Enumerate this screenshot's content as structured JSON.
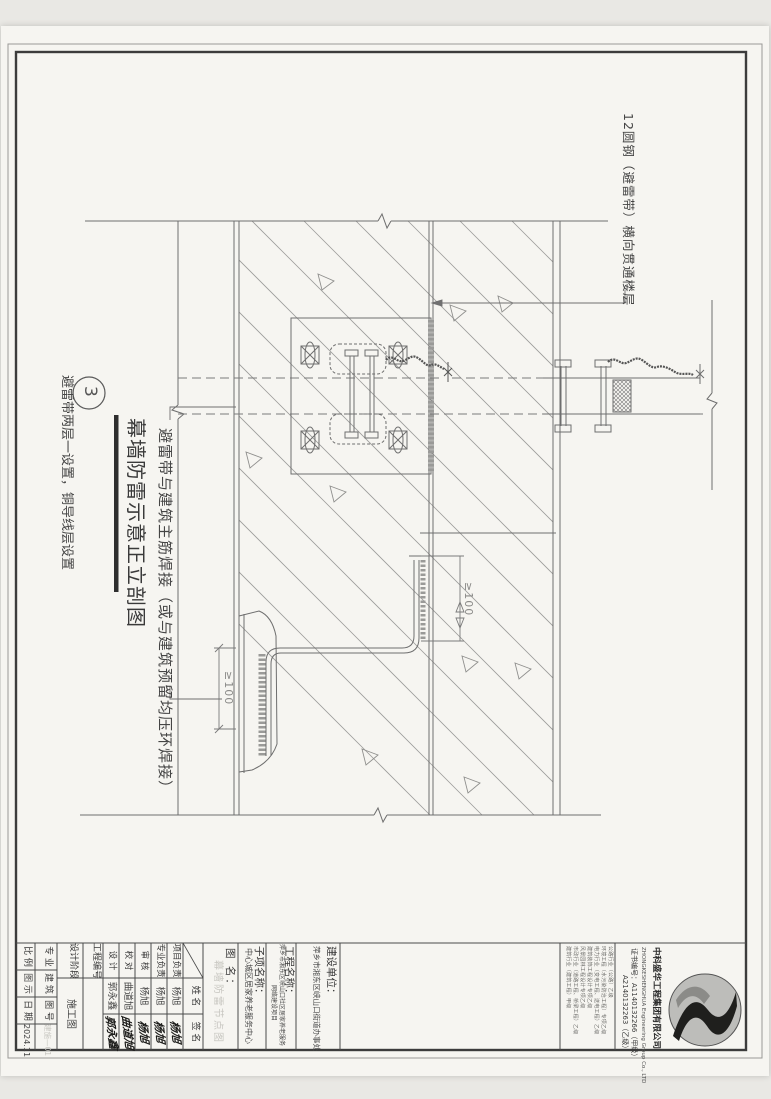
{
  "sheet": {
    "figure": {
      "number": "3",
      "title": "幕墙防雷示意正立剖图",
      "subtitle": "避雷带两层一设置，铜导线层设置"
    },
    "annotations": {
      "top_right": "12圆钢（避雷带）横向贯通楼层",
      "weld_note": "避雷带与建筑主筋焊接（或与建筑预留均压环焊接）",
      "dim_upper": "≥100",
      "dim_lower": "≥100"
    },
    "titleblock": {
      "company": {
        "name": "中科盛华工程集团有限公司",
        "name_en": "ZHONGKESHENGHUA Engineering Group Co., LTD",
        "cert1": "证书编号：A1140132266（甲级）",
        "cert2": "A2140132263（乙级）",
        "qual1": "建筑行业（建筑工程）甲级",
        "qual2": "市政行业（道路工程、桥梁工程）乙级",
        "qual3": "风景园林工程设计专项乙级",
        "qual4": "建筑装饰工程设计专项乙级",
        "qual5": "电力行业（变电工程、送电工程）乙级",
        "qual6": "环境工程（水污染防治工程）专项乙级",
        "qual7": "公路行业（公路）乙级"
      },
      "fields": {
        "owner_label": "建设单位：",
        "owner_value": "萍乡市湘东区峡山口街道办事处",
        "project_label": "工程名称：",
        "project_value_1": "萍乡市湘东区峡山口社区居家养老服务",
        "project_value_2": "网络建设项目",
        "sub_label": "子项名称：",
        "sub_value": "中心城区居家养老服务中心",
        "dwg_label": "图  名：",
        "dwg_value_faint": "幕墙防雷节点图",
        "header_name": "姓 名",
        "header_sign": "签 名",
        "personnel": [
          {
            "role": "项目负责",
            "name": "杨旭"
          },
          {
            "role": "专业负责",
            "name": "杨旭"
          },
          {
            "role": "审  核",
            "name": "杨旭"
          },
          {
            "role": "校  对",
            "name": "曲道旭"
          },
          {
            "role": "设  计",
            "name": "郭永鑫"
          }
        ],
        "proj_no_label": "工程编号",
        "stage_label": "设计阶段",
        "stage_value": "施工图",
        "spec_label": "专 业",
        "spec_value": "建 筑",
        "dwgno_label": "图 号",
        "dwgno_value": "建施—01",
        "scale_label": "比 例",
        "scale_value": "图 示",
        "date_label": "日 期",
        "date_value": "2024.11"
      }
    }
  }
}
